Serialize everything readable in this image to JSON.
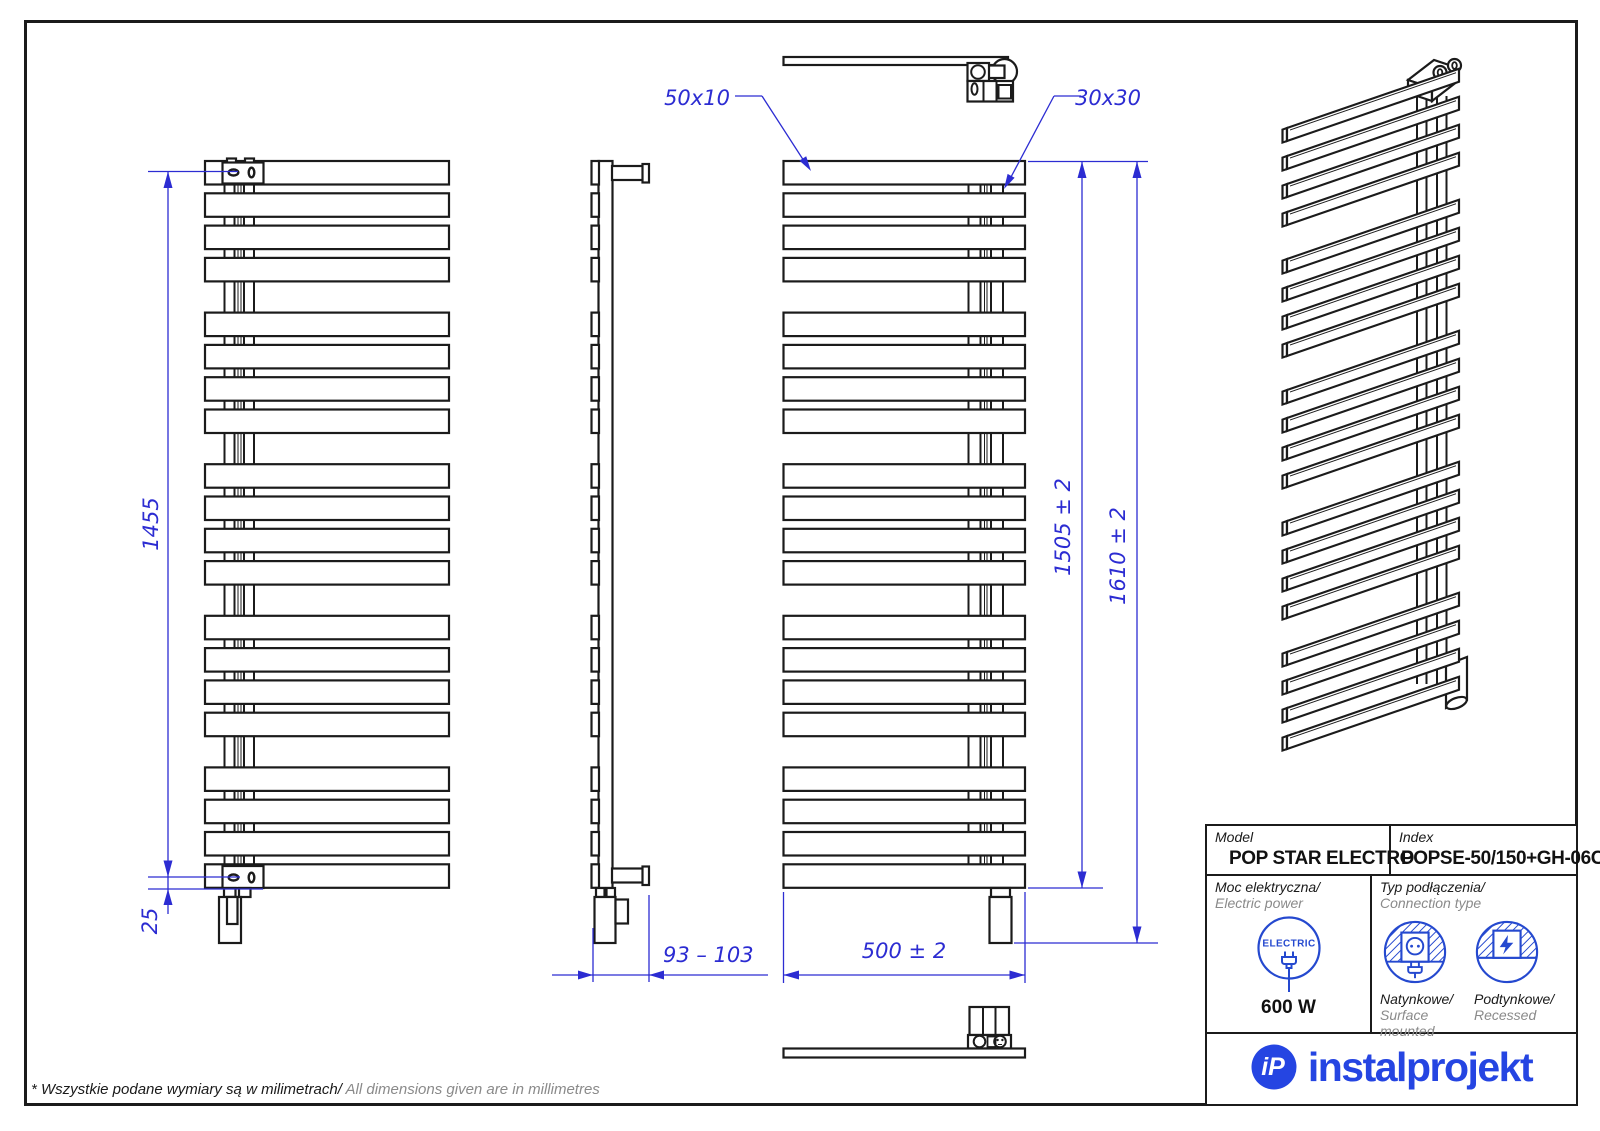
{
  "colors": {
    "line_black": "#1b1b1b",
    "dim_blue": "#2c2cd2",
    "icon_blue": "#2549cf",
    "logo_blue": "#2545e2",
    "text_gray": "#8a8a8a"
  },
  "drawing": {
    "slat_count": 20,
    "slats_per_group": 4,
    "group_count": 5,
    "dimensions": {
      "height_axis": "1455",
      "bottom_offset": "25",
      "wall_distance": "93 – 103",
      "width": "500 ± 2",
      "height_to_last_slat": "1505 ± 2",
      "height_overall": "1610 ± 2",
      "slat_profile": "50x10",
      "collector_profile": "30x30"
    }
  },
  "title_block": {
    "model_label": "Model",
    "model_value": "POP STAR ELECTRO",
    "index_label": "Index",
    "index_value": "POPSE-50/150+GH-06C1",
    "power_label_pl": "Moc elektryczna/",
    "power_label_en": " Electric power",
    "power_value": "600 W",
    "electric_badge": "ELECTRIC",
    "connection_label_pl": "Typ podłączenia/",
    "connection_label_en": "Connection type",
    "surface_label_pl": "Natynkowe/",
    "surface_label_en": "Surface mounted",
    "recessed_label_pl": "Podtynkowe/",
    "recessed_label_en": "Recessed"
  },
  "logo": {
    "monogram": "iP",
    "wordmark": "instalprojekt"
  },
  "footnote": {
    "pl": "* Wszystkie podane wymiary są w milimetrach/",
    "en": " All dimensions given are in millimetres"
  }
}
